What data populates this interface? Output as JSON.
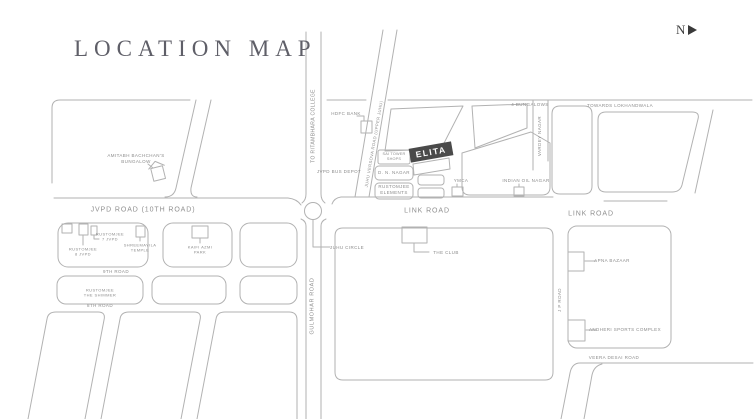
{
  "title": "LOCATION MAP",
  "compass": {
    "north": "N"
  },
  "colors": {
    "line": "#b2b2b2",
    "text": "#8c8c8c",
    "elita_bg": "#4a4a4a"
  },
  "labels": {
    "ritambhara": "TO RITAMBHARA COLLEGE",
    "juhu_versova": "JUHU VERSOVA ROAD (UPPER JUHU)",
    "hdfc": "HDFC BANK",
    "bus_depot": "JVPD BUS DEPOT",
    "four_bungalows": "4 BUNGALOWS",
    "lokhandwala": "TOWARDS LOKHANDWALA",
    "vardey_nagar": "VARDEY NAGAR",
    "elita": "ELITA",
    "sai_tower": [
      "SAI TOWER",
      "SHOPS"
    ],
    "dn_nagar": "D. N. NAGAR",
    "rustomjee_elements": [
      "RUSTOMJEE",
      "ELEMENTS"
    ],
    "ymca": "YMCA",
    "indian_oil": "INDIAN OIL NAGAR",
    "amitabh": [
      "AMITABH BACHCHAN'S",
      "BUNGALOW"
    ],
    "jvpd_road": "JVPD ROAD (10TH ROAD)",
    "rustomjee7": [
      "RUSTOMJEE",
      "7 JVPD"
    ],
    "rustomjee8": [
      "RUSTOMJEE",
      "8 JVPD"
    ],
    "temple": [
      "SHREEMAYILA",
      "TEMPLE"
    ],
    "kaifi": [
      "KAIFI AZMI",
      "PARK"
    ],
    "ninth_road": "9TH ROAD",
    "shimmer": [
      "RUSTOMJEE",
      "THE SHIMMER"
    ],
    "eighth_road": "8TH ROAD",
    "juhu_circle": "JUHU CIRCLE",
    "link_road_center": "LINK ROAD",
    "the_club": "THE CLUB",
    "gulmohar": "GULMOHAR ROAD",
    "link_road_right": "LINK ROAD",
    "jp_road": "J P ROAD",
    "apna_bazaar": "APNA BAZAAR",
    "andheri_sports": "ANDHERI SPORTS COMPLEX",
    "veera_desai": "VEERA DESAI ROAD"
  }
}
